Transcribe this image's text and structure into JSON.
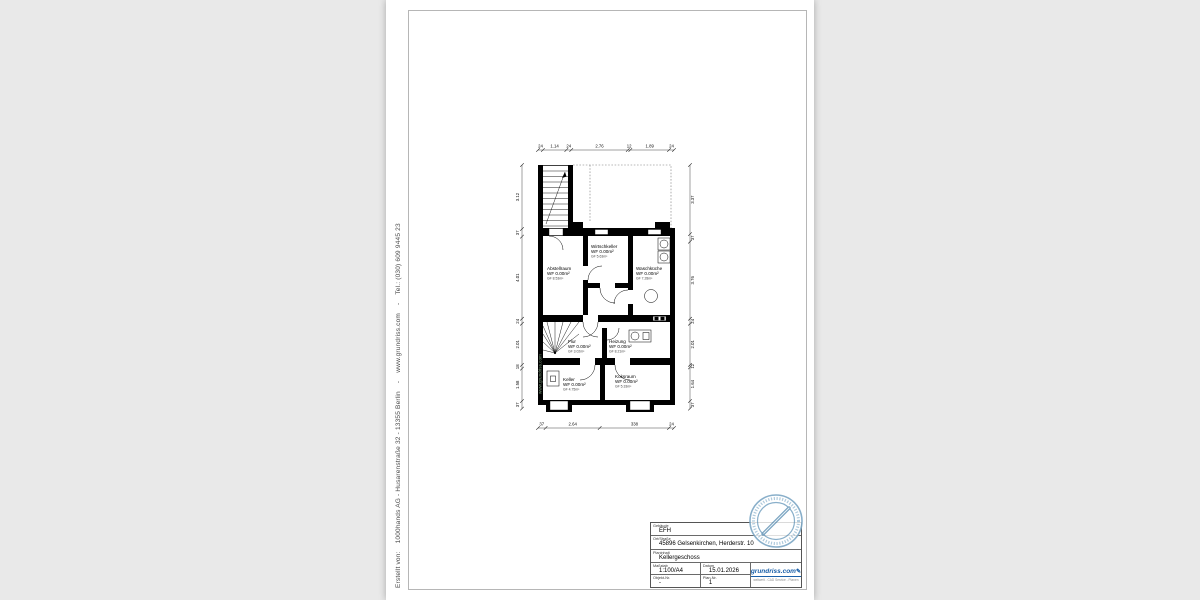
{
  "side_text": "Erstellt von:    1000hands AG - Husarenstraße 32 - 13355 Berlin    -    www.grundriss.com    -    Tel.: (030) 609 9445 23",
  "watermark": "www.grundriss.com",
  "plan": {
    "rooms": [
      {
        "name": "Abstellraum",
        "wf": "WF 0.00m²",
        "gf": "GF 8.53m²"
      },
      {
        "name": "Wirtschkeller",
        "wf": "WF 0.00m²",
        "gf": "GF 5.63m²"
      },
      {
        "name": "Waschküche",
        "wf": "WF 0.00m²",
        "gf": "GF 7.28m²"
      },
      {
        "name": "Flur",
        "wf": "WF 0.00m²",
        "gf": "GF 3.02m²"
      },
      {
        "name": "Heizung",
        "wf": "WF 0.00m²",
        "gf": "GF 8.21m²"
      },
      {
        "name": "Keller",
        "wf": "WF 0.00m²",
        "gf": "GF 4.75m²"
      },
      {
        "name": "Koksraum",
        "wf": "WF 0.00m²",
        "gf": "GF 5.33m²"
      }
    ],
    "dims": {
      "top": [
        "24",
        "1.14",
        "24",
        "2.76",
        "12",
        "1.89",
        "24"
      ],
      "bottom": [
        "37",
        "2.64",
        "338",
        "24"
      ],
      "left": [
        "3.12",
        "37",
        "4.01",
        "24",
        "2.01",
        "18",
        "1.58",
        "37"
      ],
      "right": [
        "3.37",
        "37",
        "3.76",
        "24",
        "2.01",
        "12",
        "1.64",
        "37"
      ]
    }
  },
  "title_block": {
    "gebaeude": {
      "label": "Gebäude",
      "value": "EFH"
    },
    "ort": {
      "label": "Ort/Straße",
      "value": "45896 Gelsenkirchen, Herderstr. 10"
    },
    "planinhalt": {
      "label": "Planinhalt",
      "value": "Kellergeschoss"
    },
    "massstab": {
      "label": "Maßstab",
      "value": "1:100/A4"
    },
    "datum": {
      "label": "Datum",
      "value": "15.01.2026"
    },
    "objekt_nr": {
      "label": "Objekt-Nr.",
      "value": "-"
    },
    "plan_nr": {
      "label": "Plan-Nr.",
      "value": "1"
    },
    "logo": {
      "text": "grundriss.com",
      "pen": "✎",
      "tagline": "weltweit - CAD Service - Planen",
      "color": "#1a5fa8"
    }
  }
}
